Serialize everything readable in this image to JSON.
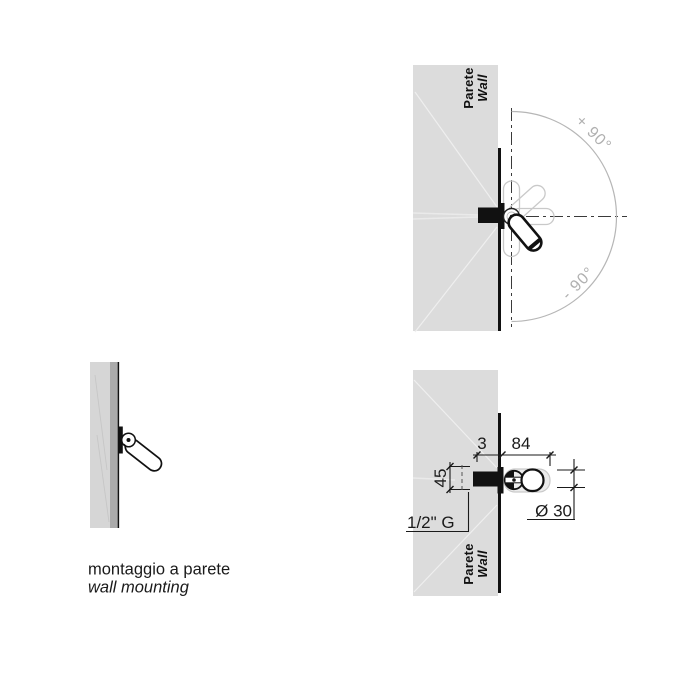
{
  "colors": {
    "wall_fill": "#dcdcdc",
    "wall_edge_dark": "#ababab",
    "outline": "#111111",
    "ghost_stroke": "#c9c9c9",
    "arc_stroke": "#b6b6b6",
    "angle_text": "#b0b0b0",
    "dim_color": "#1a1a1a"
  },
  "rotation_view": {
    "wall_label_it": "Parete",
    "wall_label_en": "Wall",
    "angle_positive": "+ 90°",
    "angle_negative": "- 90°"
  },
  "dimension_view": {
    "wall_label_it": "Parete",
    "wall_label_en": "Wall",
    "dim_offset": "3",
    "dim_length": "84",
    "dim_height": "45",
    "dim_diameter": "Ø 30",
    "thread_spec": "1/2\" G"
  },
  "caption": {
    "line_it": "montaggio a parete",
    "line_en": "wall mounting"
  }
}
